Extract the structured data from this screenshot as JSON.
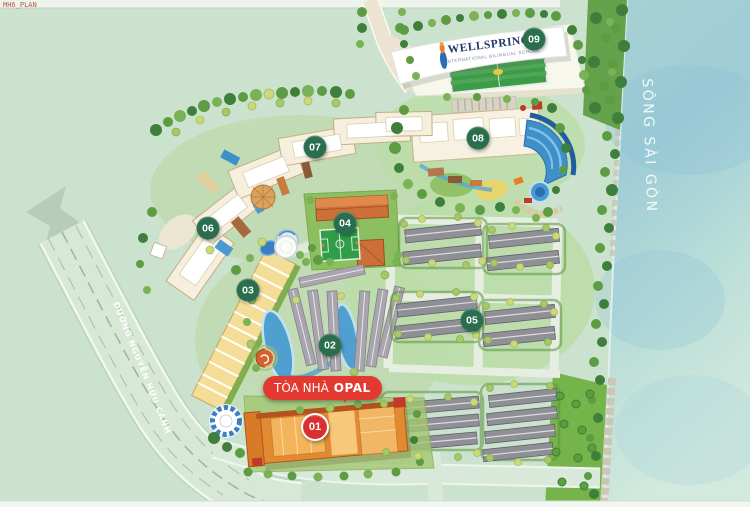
{
  "watermark": "MH6_PLAN",
  "map": {
    "river_label": "SÔNG SÀI GÒN",
    "road_label": "ĐƯỜNG NGUYỄN HỮU CẢNH",
    "school": {
      "name": "WELLSPRING",
      "subtitle": "INTERNATIONAL BILINGUAL SCHOOL"
    },
    "opal_badge": {
      "prefix": "TÒA NHÀ",
      "name": "OPAL"
    }
  },
  "markers": [
    {
      "label": "01",
      "x": 315,
      "y": 427,
      "color": "#d8302f",
      "type": "highlight"
    },
    {
      "label": "02",
      "x": 330,
      "y": 345,
      "color": "#2a6e4f"
    },
    {
      "label": "03",
      "x": 248,
      "y": 290,
      "color": "#2a6e4f"
    },
    {
      "label": "04",
      "x": 345,
      "y": 223,
      "color": "#2a6e4f"
    },
    {
      "label": "05",
      "x": 472,
      "y": 320,
      "color": "#2a6e4f"
    },
    {
      "label": "06",
      "x": 208,
      "y": 228,
      "color": "#2a6e4f"
    },
    {
      "label": "07",
      "x": 315,
      "y": 147,
      "color": "#2a6e4f"
    },
    {
      "label": "08",
      "x": 478,
      "y": 138,
      "color": "#2a6e4f"
    },
    {
      "label": "09",
      "x": 534,
      "y": 39,
      "color": "#2a6e4f"
    }
  ],
  "colors": {
    "background": "#cbe2cf",
    "river": "#a8d3d6",
    "road": "#d7e8d7",
    "marker_green": "#2a6e4f",
    "marker_red": "#d8302f",
    "badge_red": "#e23a30",
    "school_navy": "#22376d",
    "building_cream": "#f6efdd",
    "opal_orange": "#e28a31",
    "pool_blue": "#3f8fc9",
    "lawn_green": "#74b44b",
    "roof_gray": "#8f8f96",
    "shophouse_yellow": "#f4dd97"
  }
}
